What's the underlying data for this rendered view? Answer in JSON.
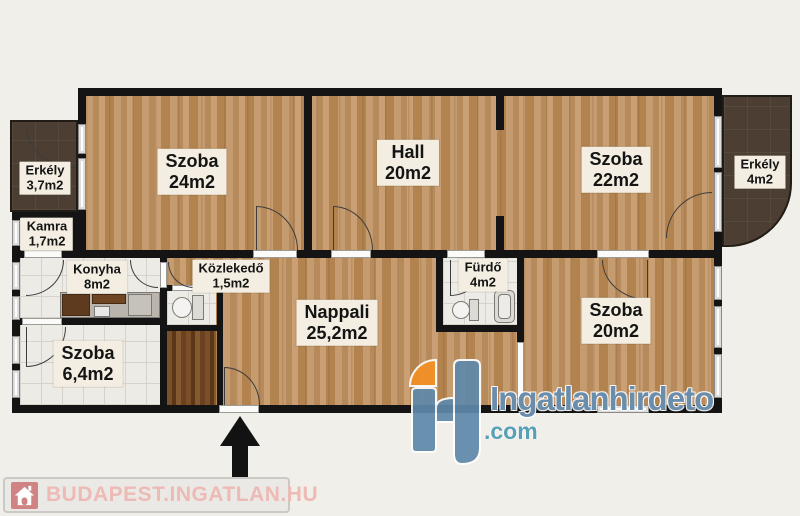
{
  "rooms": {
    "szoba24": {
      "name": "Szoba",
      "area": "24m2"
    },
    "hall": {
      "name": "Hall",
      "area": "20m2"
    },
    "szoba22": {
      "name": "Szoba",
      "area": "22m2"
    },
    "erkely_left": {
      "name": "Erkély",
      "area": "3,7m2"
    },
    "kamra": {
      "name": "Kamra",
      "area": "1,7m2"
    },
    "konyha": {
      "name": "Konyha",
      "area": "8m2"
    },
    "kozlekedo": {
      "name": "Közlekedő",
      "area": "1,5m2"
    },
    "furdo": {
      "name": "Fürdő",
      "area": "4m2"
    },
    "szoba64": {
      "name": "Szoba",
      "area": "6,4m2"
    },
    "nappali": {
      "name": "Nappali",
      "area": "25,2m2"
    },
    "szoba20": {
      "name": "Szoba",
      "area": "20m2"
    },
    "erkely_right": {
      "name": "Erkély",
      "area": "4m2"
    }
  },
  "watermark": {
    "brand": "Ingatlanhirdeto",
    "tld": ".com"
  },
  "footer": {
    "site": "BUDAPEST.INGATLAN.HU"
  },
  "icons": {
    "entrance": "arrow-up-icon",
    "footer": "house-icon",
    "watermark": "h-monogram-icon"
  },
  "colors": {
    "background": "#f1efe9",
    "wall": "#141414",
    "wood_floor": "#bc9166",
    "dark_wood": "#6b4220",
    "balcony": "#4c3e33",
    "tile": "#edebe6",
    "label_bg": "#f3eee1",
    "watermark_blue": "#5f89ab",
    "watermark_orange": "#f39123",
    "watermark_teal": "#4a96af",
    "footer_pink": "#eebab5"
  }
}
